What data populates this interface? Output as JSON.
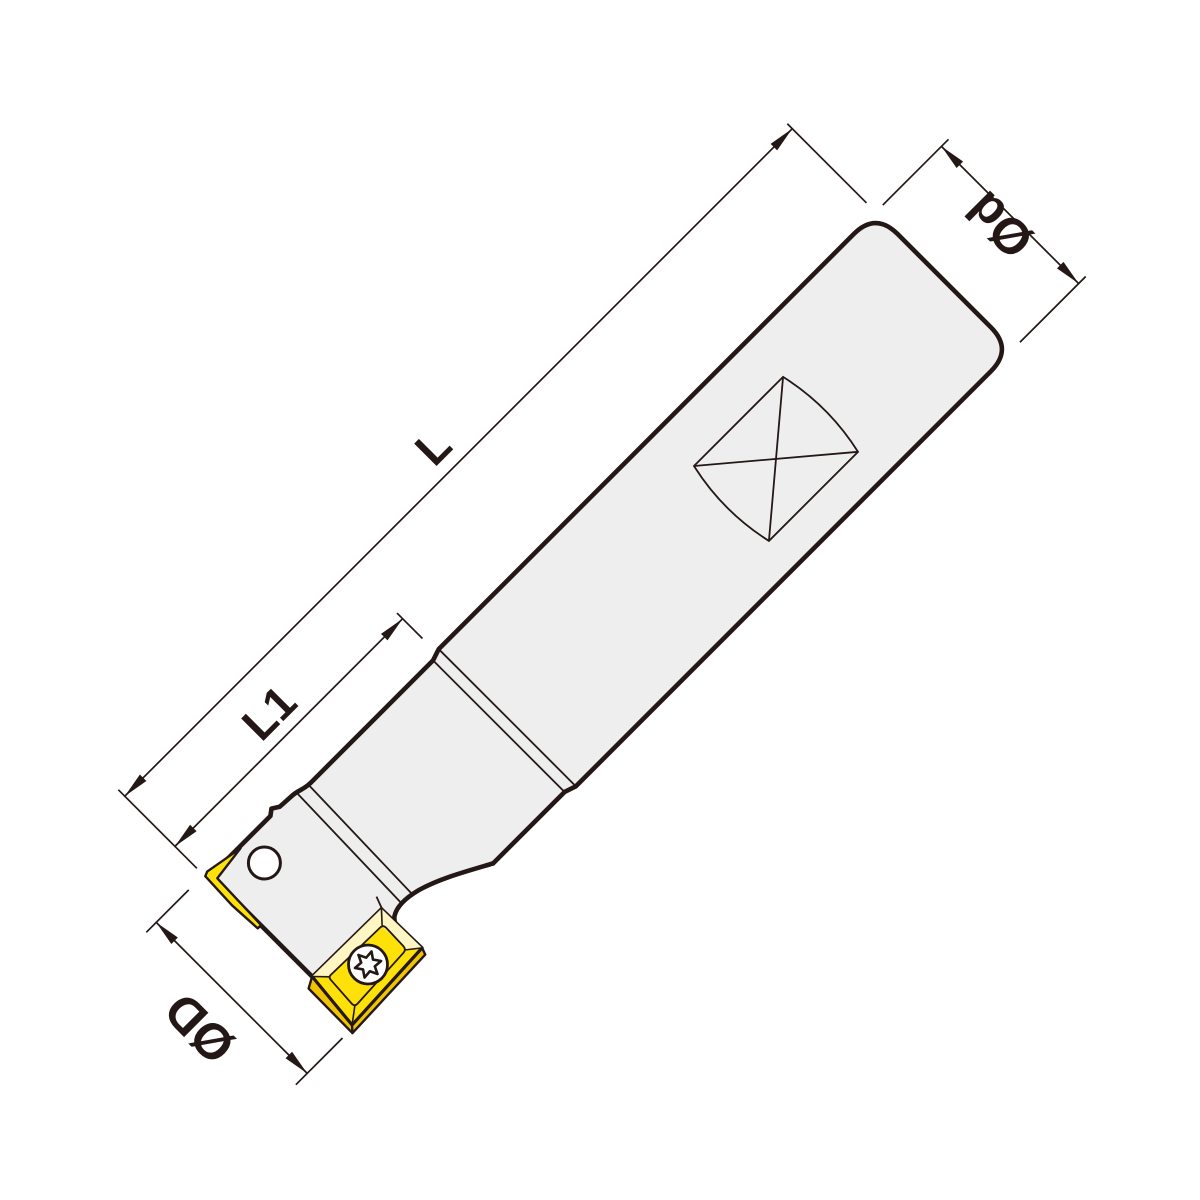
{
  "diagram": {
    "type": "technical-drawing",
    "subject": "indexable-insert end mill cutter, side view, drawn at 45 degrees",
    "labels": {
      "overall_length": "L",
      "cutting_head_length": "L1",
      "shank_diameter": "Ød",
      "cutter_diameter": "ØD"
    },
    "features": {
      "shank": "cylindrical shank with rounded end and weldon flat symbol",
      "flat_symbol": "square with crossed diagonals and bulged ends",
      "transition": "double ring groove between shank and neck",
      "front_insert": "yellow parallelogram carbide insert with torx screw",
      "back_insert": "second insert visible edge-on at head face",
      "screw_hole": "round hole on head"
    },
    "colors": {
      "background": "#ffffff",
      "outline": "#231815",
      "body_fill": "#efeeef",
      "insert_yellow": "#ffe10a",
      "insert_bevel": "#fff6c4",
      "insert_side": "#f0c400",
      "screw_fill": "#ffffff"
    }
  }
}
